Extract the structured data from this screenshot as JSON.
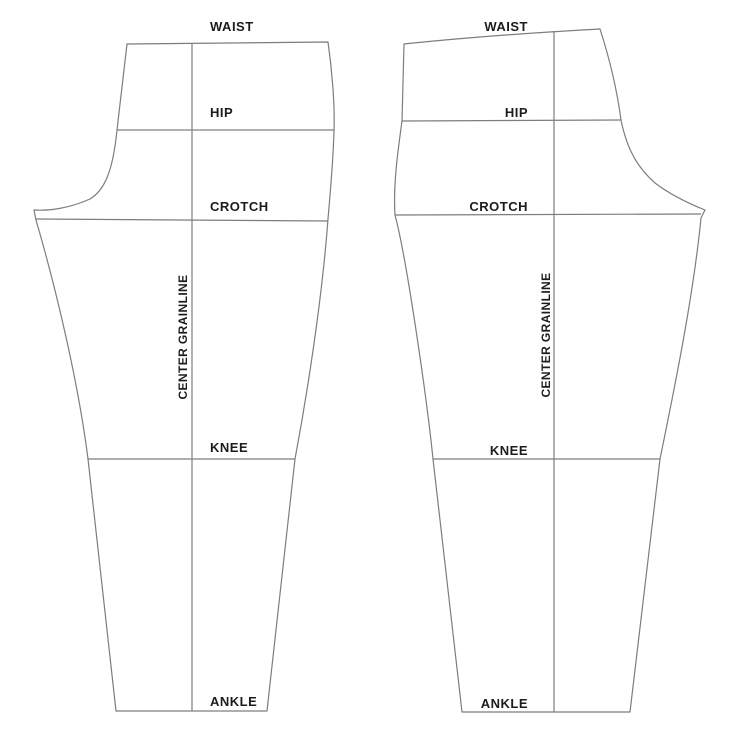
{
  "diagram": {
    "type": "sewing-pattern-draft",
    "subject": "pants pattern front and back pieces with reference lines",
    "colors": {
      "background": "#ffffff",
      "line": "#7d7d7d",
      "text": "#1c1c1c"
    },
    "pieces": [
      {
        "id": "front",
        "grainline_label": "CENTER GRAINLINE",
        "levels": {
          "waist": "WAIST",
          "hip": "HIP",
          "crotch": "CROTCH",
          "knee": "KNEE",
          "ankle": "ANKLE"
        }
      },
      {
        "id": "back",
        "grainline_label": "CENTER GRAINLINE",
        "levels": {
          "waist": "WAIST",
          "hip": "HIP",
          "crotch": "CROTCH",
          "knee": "KNEE",
          "ankle": "ANKLE"
        }
      }
    ]
  }
}
